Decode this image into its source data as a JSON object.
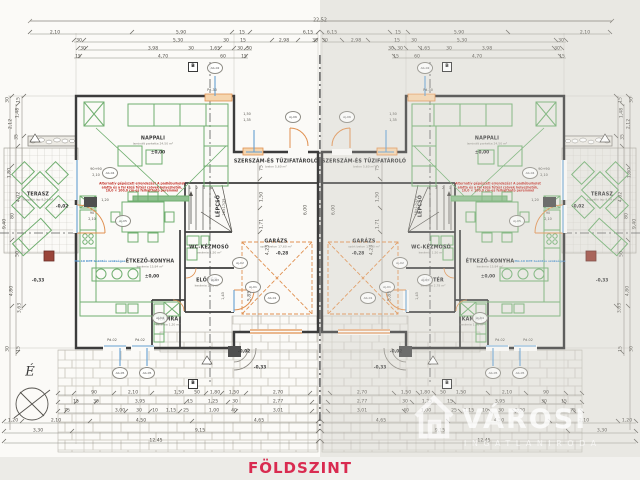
{
  "title": {
    "floor": "FÖLDSZINT"
  },
  "watermark": {
    "name": "VÁROSI",
    "sub": "INGATLANIRODA"
  },
  "compass": {
    "north": "É"
  },
  "overall_dimension": "22,52",
  "colors": {
    "title_red": "#d92b50",
    "furniture_green": "#6fae6f",
    "door_orange": "#e09050",
    "opening_blue": "#64a0d2"
  },
  "unit": {
    "rooms": [
      {
        "x": 153,
        "y": 141,
        "label": "NAPPALI",
        "sub": "laminált parketta 24,50 m²"
      },
      {
        "x": 150,
        "y": 264,
        "label": "ÉTKEZŐ-KONYHA",
        "sub": "kerámia 15,84 m²"
      },
      {
        "x": 168,
        "y": 322,
        "label": "KAMRA",
        "sub": "kerámia 1,20 m²"
      },
      {
        "x": 207,
        "y": 283,
        "label": "ELŐTÉR",
        "sub": "kerámia 2,78 m²"
      },
      {
        "x": 209,
        "y": 250,
        "label": "WC-KÉZMOSÓ",
        "sub": "kerámia 1,50 m²"
      },
      {
        "x": 219,
        "y": 206,
        "label": "LÉPCSŐ",
        "rot": true
      },
      {
        "x": 276,
        "y": 164,
        "label": "SZERSZÁM-ÉS TŰZIFATÁROLÓ",
        "sub": "beton 5,60 m²"
      },
      {
        "x": 276,
        "y": 244,
        "label": "GARÁZS",
        "sub": "szórt beton 17,60 m²"
      },
      {
        "x": 38,
        "y": 197,
        "label": "TERASZ",
        "sub": "fagyálló lap 9,24 m²"
      }
    ],
    "levels": [
      {
        "x": 158,
        "y": 153,
        "t": "±0,00"
      },
      {
        "x": 152,
        "y": 277,
        "t": "±0,00"
      },
      {
        "x": 62,
        "y": 207,
        "t": "-0,02"
      },
      {
        "x": 244,
        "y": 352,
        "t": "-0,02"
      },
      {
        "x": 282,
        "y": 254,
        "t": "-0,28"
      },
      {
        "x": 38,
        "y": 281,
        "t": "-0,33"
      },
      {
        "x": 260,
        "y": 368,
        "t": "-0,33"
      }
    ],
    "markers": [
      {
        "x": 215,
        "y": 68,
        "t": "Ab-02"
      },
      {
        "x": 110,
        "y": 173,
        "t": "Ab-04"
      },
      {
        "x": 123,
        "y": 221,
        "t": "Aj-05"
      },
      {
        "x": 293,
        "y": 117,
        "t": "Aj-06"
      },
      {
        "x": 120,
        "y": 373,
        "t": "Ab-05"
      },
      {
        "x": 147,
        "y": 373,
        "t": "Ab-05"
      },
      {
        "x": 253,
        "y": 287,
        "t": "Aj-01"
      },
      {
        "x": 272,
        "y": 298,
        "t": "Ab-01"
      },
      {
        "x": 160,
        "y": 318,
        "t": "Aj-04"
      },
      {
        "x": 215,
        "y": 280,
        "t": "Aj-03"
      },
      {
        "x": 240,
        "y": 263,
        "t": "Aj-02"
      }
    ],
    "b_markers": [
      {
        "x": 193,
        "y": 67,
        "t": "B"
      },
      {
        "x": 193,
        "y": 384,
        "t": "B"
      }
    ],
    "dim_rows": [
      {
        "y": 33,
        "items": [
          [
            55,
            "2,10"
          ],
          [
            181,
            "5,90"
          ],
          [
            242,
            "15"
          ],
          [
            308,
            "6,15"
          ]
        ]
      },
      {
        "y": 41,
        "items": [
          [
            79,
            "30"
          ],
          [
            178,
            "5,30"
          ],
          [
            226,
            "30"
          ],
          [
            243,
            "15"
          ],
          [
            284,
            "2,98"
          ],
          [
            315,
            "30"
          ]
        ]
      },
      {
        "y": 49,
        "items": [
          [
            83,
            "30"
          ],
          [
            153,
            "3,98"
          ],
          [
            191,
            "30"
          ],
          [
            215,
            "1,65"
          ],
          [
            240,
            "30"
          ],
          [
            249,
            "30"
          ]
        ]
      },
      {
        "y": 57,
        "items": [
          [
            78,
            "15"
          ],
          [
            163,
            "4,70"
          ],
          [
            223,
            "60"
          ],
          [
            244,
            "15"
          ]
        ]
      },
      {
        "y": 393,
        "items": [
          [
            94,
            "90"
          ],
          [
            133,
            "2,10"
          ],
          [
            179,
            "1,50"
          ],
          [
            197,
            "50"
          ],
          [
            215,
            "1,80"
          ],
          [
            234,
            "1,50"
          ],
          [
            278,
            "2,70"
          ]
        ]
      },
      {
        "y": 402,
        "items": [
          [
            76,
            "15"
          ],
          [
            96,
            "30"
          ],
          [
            140,
            "3,95"
          ],
          [
            190,
            "15"
          ],
          [
            213,
            "1,25"
          ],
          [
            235,
            "30"
          ],
          [
            278,
            "2,77"
          ]
        ]
      },
      {
        "y": 411,
        "items": [
          [
            67,
            "75"
          ],
          [
            120,
            "3,00"
          ],
          [
            139,
            "30"
          ],
          [
            155,
            "10"
          ],
          [
            171,
            "1,15"
          ],
          [
            186,
            "25"
          ],
          [
            214,
            "1,00"
          ],
          [
            234,
            "40"
          ],
          [
            278,
            "3,01"
          ]
        ]
      },
      {
        "y": 421,
        "items": [
          [
            13,
            "1,20"
          ],
          [
            56,
            "2,10"
          ],
          [
            141,
            "4,50"
          ],
          [
            259,
            "4,65"
          ]
        ]
      },
      {
        "y": 431,
        "items": [
          [
            38,
            "3,30"
          ],
          [
            200,
            "9,15"
          ]
        ]
      },
      {
        "y": 441,
        "items": [
          [
            156,
            "12,45"
          ]
        ]
      }
    ],
    "dim_rot": [
      {
        "x": 8,
        "y": 100,
        "t": "30"
      },
      {
        "x": 19,
        "y": 100,
        "t": "15"
      },
      {
        "x": 18,
        "y": 113,
        "t": "1,48"
      },
      {
        "x": 11,
        "y": 124,
        "t": "2,12"
      },
      {
        "x": 17,
        "y": 137,
        "t": "35"
      },
      {
        "x": 10,
        "y": 173,
        "t": "1,80"
      },
      {
        "x": 19,
        "y": 197,
        "t": "4,02"
      },
      {
        "x": 13,
        "y": 216,
        "t": "80"
      },
      {
        "x": 5,
        "y": 224,
        "t": "9,40"
      },
      {
        "x": 18,
        "y": 254,
        "t": "50"
      },
      {
        "x": 12,
        "y": 291,
        "t": "4,80"
      },
      {
        "x": 20,
        "y": 308,
        "t": "3,63"
      },
      {
        "x": 8,
        "y": 349,
        "t": "30"
      },
      {
        "x": 19,
        "y": 349,
        "t": "15"
      },
      {
        "x": 262,
        "y": 168,
        "t": "75"
      },
      {
        "x": 262,
        "y": 197,
        "t": "1,50"
      },
      {
        "x": 262,
        "y": 224,
        "t": "1,71"
      },
      {
        "x": 268,
        "y": 250,
        "t": "4,23"
      },
      {
        "x": 250,
        "y": 296,
        "t": "5,85"
      },
      {
        "x": 306,
        "y": 210,
        "t": "6,00"
      }
    ],
    "small_texts": [
      {
        "x": 96,
        "y": 169,
        "t": "90+90"
      },
      {
        "x": 96,
        "y": 175,
        "t": "2,10"
      },
      {
        "x": 92,
        "y": 213,
        "t": "90"
      },
      {
        "x": 92,
        "y": 219,
        "t": "2,10"
      },
      {
        "x": 105,
        "y": 200,
        "t": "1,20"
      },
      {
        "x": 247,
        "y": 114,
        "t": "1,50"
      },
      {
        "x": 247,
        "y": 120,
        "t": "1,35"
      },
      {
        "x": 112,
        "y": 340,
        "t": "Pd-02"
      },
      {
        "x": 140,
        "y": 340,
        "t": "Pd-02"
      },
      {
        "x": 212,
        "y": 90,
        "t": "Pd-30"
      },
      {
        "x": 224,
        "y": 207,
        "t": "18×17/29",
        "rot": true
      },
      {
        "x": 223,
        "y": 296,
        "t": "1,43",
        "rot": true
      }
    ],
    "stair_numbers": [
      {
        "x": 190,
        "y": 188,
        "t": "1"
      },
      {
        "x": 197,
        "y": 188,
        "t": "2"
      },
      {
        "x": 204,
        "y": 188,
        "t": "3"
      },
      {
        "x": 211,
        "y": 188,
        "t": "4"
      }
    ],
    "notes_red": [
      {
        "x": 142,
        "y": 188,
        "lines": [
          "Alternatív gépészeti elrendezés! A padlóburkolat",
          "alatta és a fal közé fűtési csövek helyezhetők,",
          "10,0 × 100,0 cm-es felhajtható peremmel"
        ]
      }
    ],
    "notes_blue": [
      {
        "x": 100,
        "y": 261,
        "lines": [
          "Mü-10 KPE bekötés szükséges"
        ]
      }
    ]
  }
}
